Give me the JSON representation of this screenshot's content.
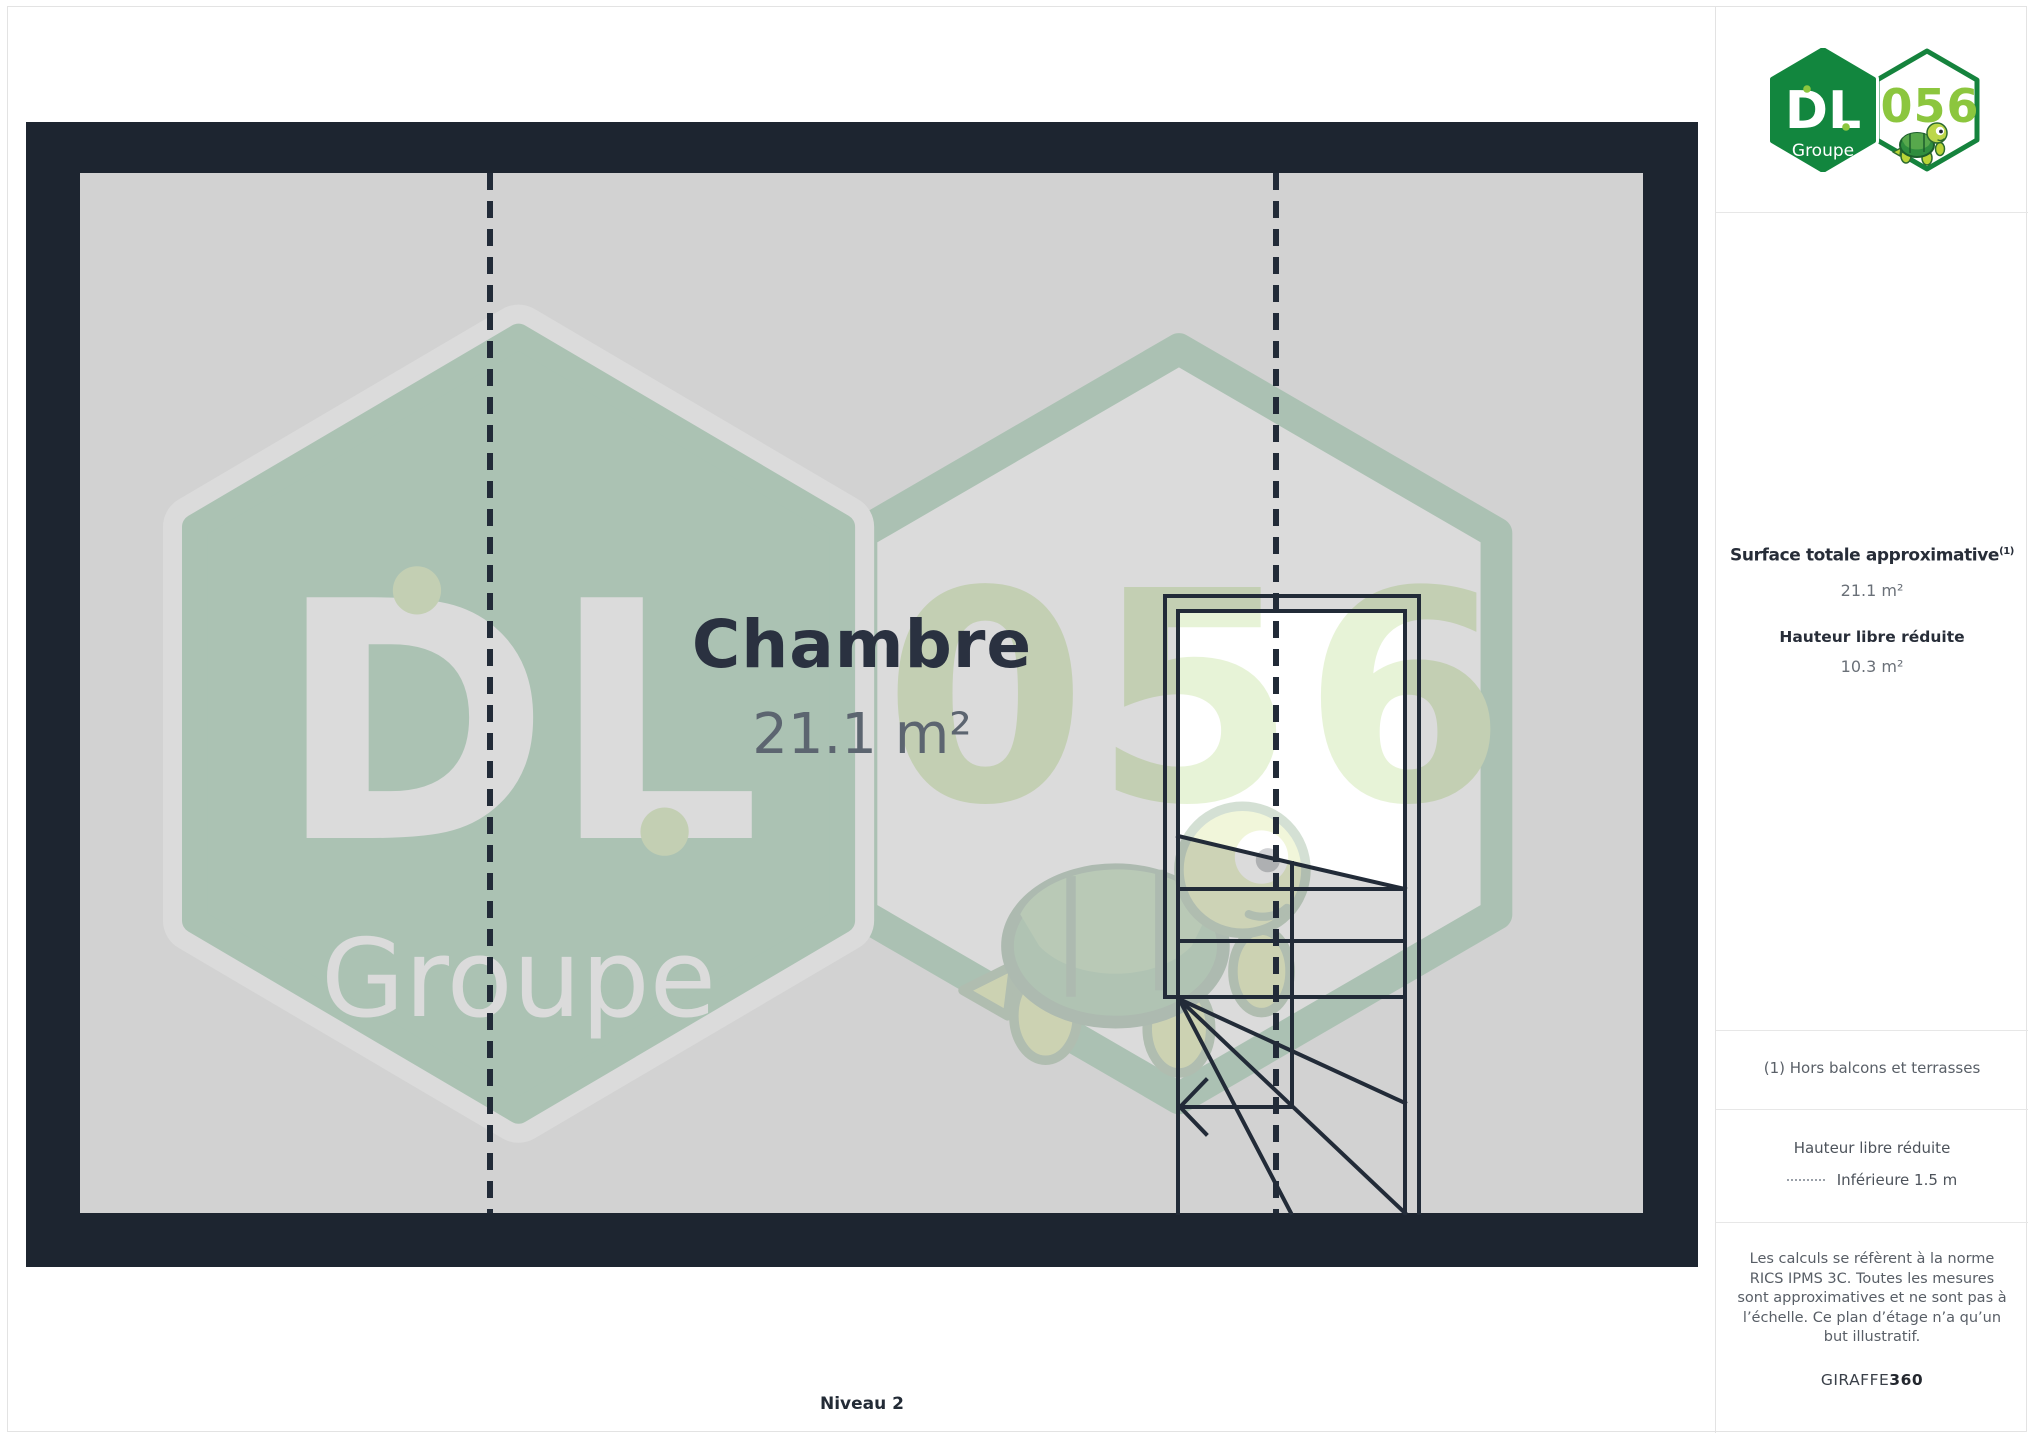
{
  "logo": {
    "dl": "DL",
    "groupe": "Groupe",
    "badge": "056"
  },
  "plan": {
    "room_label": "Chambre",
    "room_area": "21.1 m²",
    "level_label": "Niveau 2"
  },
  "sidebar": {
    "surface_title": "Surface totale approximative",
    "surface_title_sup": "(1)",
    "surface_value": "21.1 m²",
    "reduced_height_title": "Hauteur libre réduite",
    "reduced_height_value": "10.3 m²",
    "footnote": "(1) Hors balcons et terrasses",
    "legend_title": "Hauteur libre réduite",
    "legend_item": "Inférieure 1.5 m",
    "disclaimer": "Les calculs se réfèrent à la norme RICS IPMS 3C. Toutes les mesures sont approximatives et ne sont pas à l’échelle. Ce plan d’étage n’a qu’un but illustratif.",
    "brand": "GIRAFFE",
    "brand_suffix": "360"
  },
  "colors": {
    "wall": "#1d2530",
    "floor": "#d2d2d2",
    "line": "#222b38",
    "brand_green": "#12863e",
    "brand_light_green": "#8cc63e",
    "text_dark": "#272d38",
    "text_grey": "#6a7078",
    "divider": "#e3e3e3"
  }
}
